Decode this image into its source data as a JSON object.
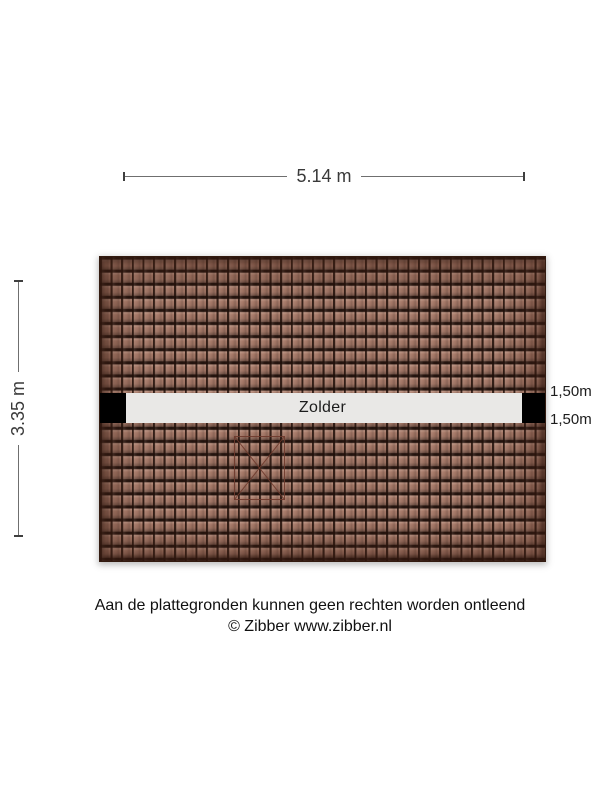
{
  "dimensions": {
    "width_label": "5.14 m",
    "height_label": "3.35 m"
  },
  "headroom": {
    "top_label": "1,50m",
    "bottom_label": "1,50m"
  },
  "room": {
    "label": "Zolder"
  },
  "footer": {
    "disclaimer": "Aan de plattegronden kunnen geen rechten worden ontleend",
    "copyright": "© Zibber www.zibber.nl"
  },
  "colors": {
    "background": "#ffffff",
    "tile_base": "#a57867",
    "tile_joint": "#2a150e",
    "roof_edge": "#55301f",
    "floor_strip": "#e9e8e6",
    "wall_block": "#000000",
    "dimension_line": "#6f6f6f",
    "dimension_tick": "#3f3f3f",
    "text": "#1c1c1c",
    "skylight_line": "#6e3a2c"
  }
}
